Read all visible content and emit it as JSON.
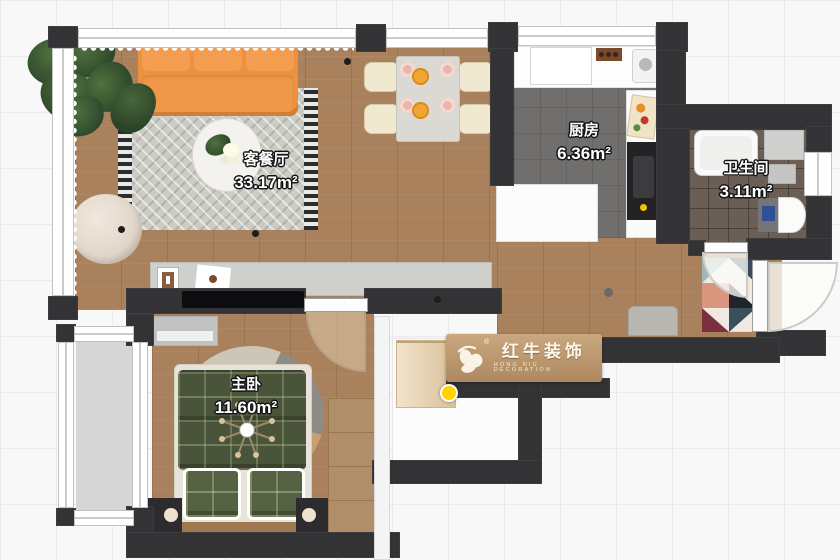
{
  "rooms": [
    {
      "id": "living",
      "name": "客餐厅",
      "area": "33.17m²"
    },
    {
      "id": "kitchen",
      "name": "厨房",
      "area": "6.36m²"
    },
    {
      "id": "bathroom",
      "name": "卫生间",
      "area": "3.11m²"
    },
    {
      "id": "bedroom",
      "name": "主卧",
      "area": "11.60m²"
    }
  ],
  "watermark": {
    "brand": "红牛装饰",
    "subtitle": "HONG NIU DECORATION",
    "registered": "®"
  },
  "colors": {
    "wall": "#333335",
    "wood_floor": "#a9815c",
    "kitchen_floor": "#716f6d",
    "bath_tile": "#6b5e55",
    "balcony_floor": "#d6d6d6",
    "sofa_orange": "#ed9140",
    "pendant_orange": "#f0a632",
    "roam_marker_yellow": "#ffd400",
    "toilet_seat_blue": "#2f4f96"
  }
}
